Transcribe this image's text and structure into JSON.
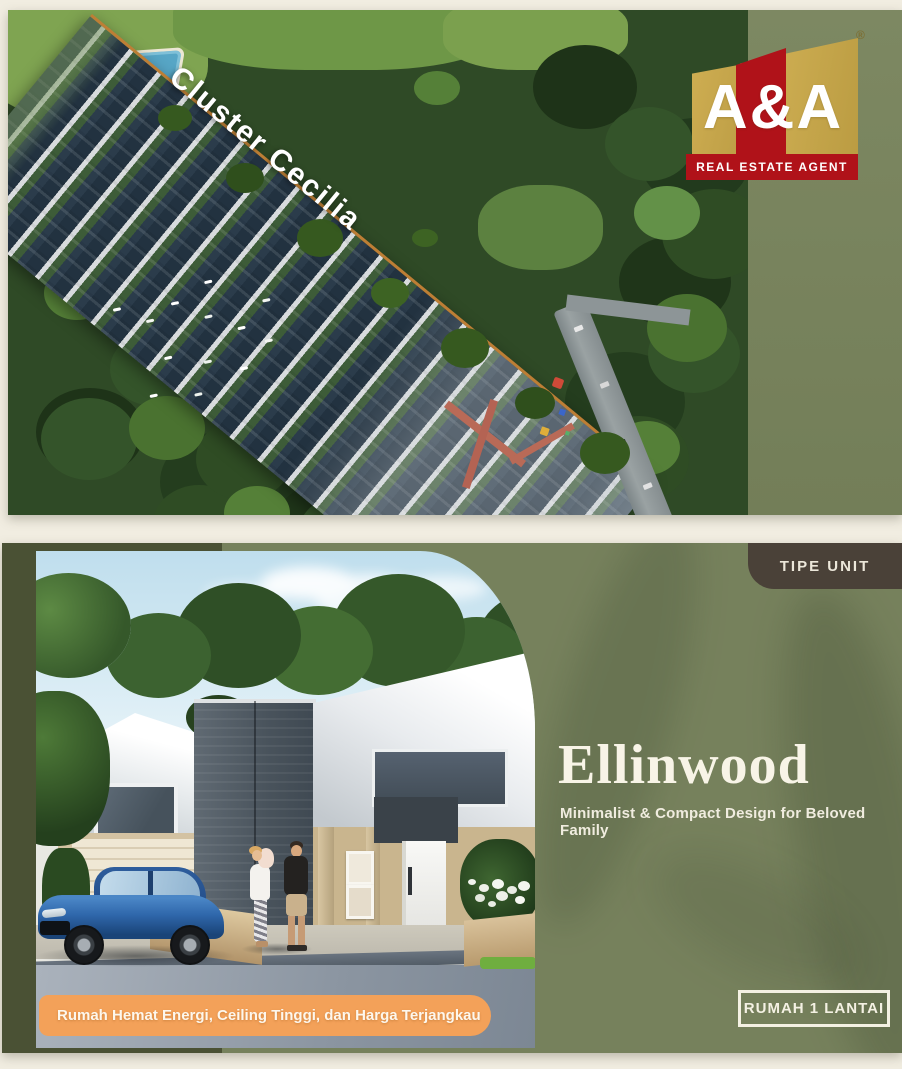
{
  "colors": {
    "cream_bg": "#f1ede1",
    "olive_bg": "#76815c",
    "dark_olive_accent": "#4a5134",
    "badge_brown": "#4a4138",
    "banner_orange": "#f3a159",
    "logo_gold": "#c8a84c",
    "logo_red": "#b01219",
    "text_cream": "#f8f4e7"
  },
  "aerial_slide": {
    "cluster_title": "Cluster Cecilia",
    "logo": {
      "brand": "A&A",
      "tagline": "REAL ESTATE AGENT",
      "registered": "®"
    }
  },
  "unit_slide": {
    "badge_label": "TIPE UNIT",
    "title": "Ellinwood",
    "subtitle": "Minimalist & Compact Design for Beloved Family",
    "unit_button_label": "RUMAH 1 LANTAI",
    "banner_text": "Rumah Hemat Energi, Ceiling Tinggi, dan Harga Terjangkau"
  }
}
